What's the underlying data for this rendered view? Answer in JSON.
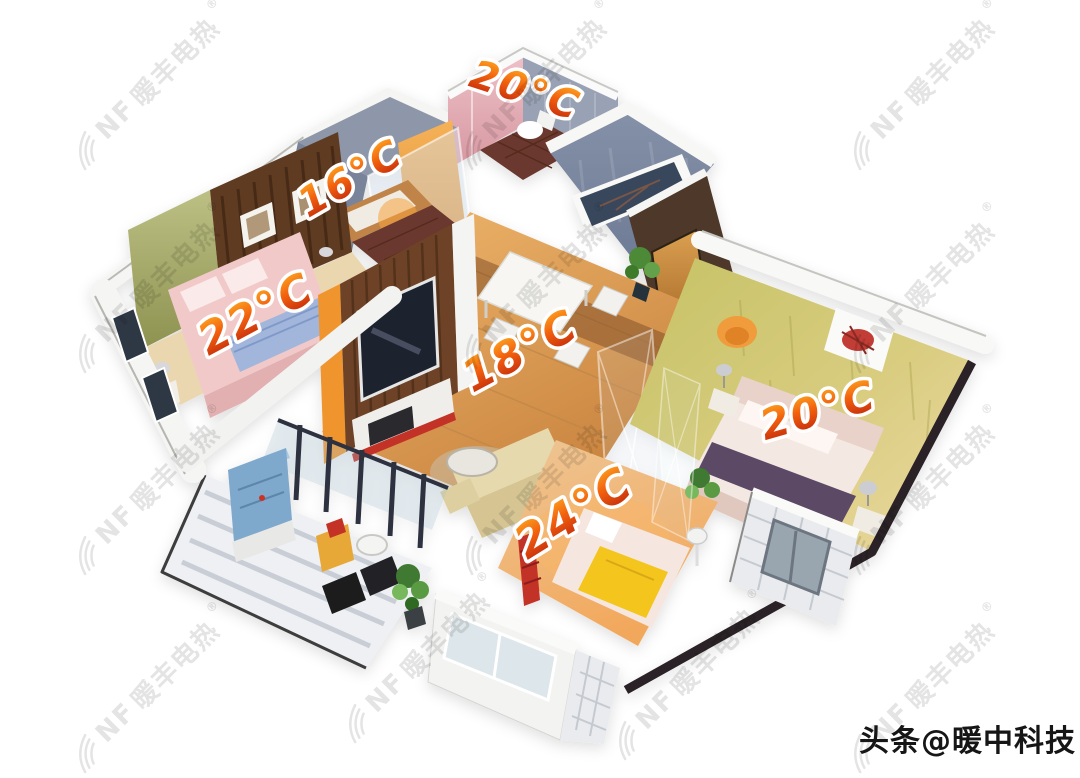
{
  "watermark": {
    "logo_icon": "fan-swirl-icon",
    "initials": "NF",
    "name": "暖丰电热",
    "registered": "®",
    "color": "#e4e4e4"
  },
  "credit": {
    "text": "头条@暖中科技",
    "color": "#161616"
  },
  "temperatures": {
    "bathroom_top": "20°C",
    "bathroom_left": "16°C",
    "bedroom_left": "22°C",
    "living_dining": "18°C",
    "children_room": "24°C",
    "master_bedroom": "20°C"
  },
  "colors": {
    "temperature_label": "#e2470c",
    "wood_floor": "#d89a50",
    "mosaic_wall": "#8e97a9",
    "master_wall": "#c8c468",
    "background": "#ffffff"
  }
}
